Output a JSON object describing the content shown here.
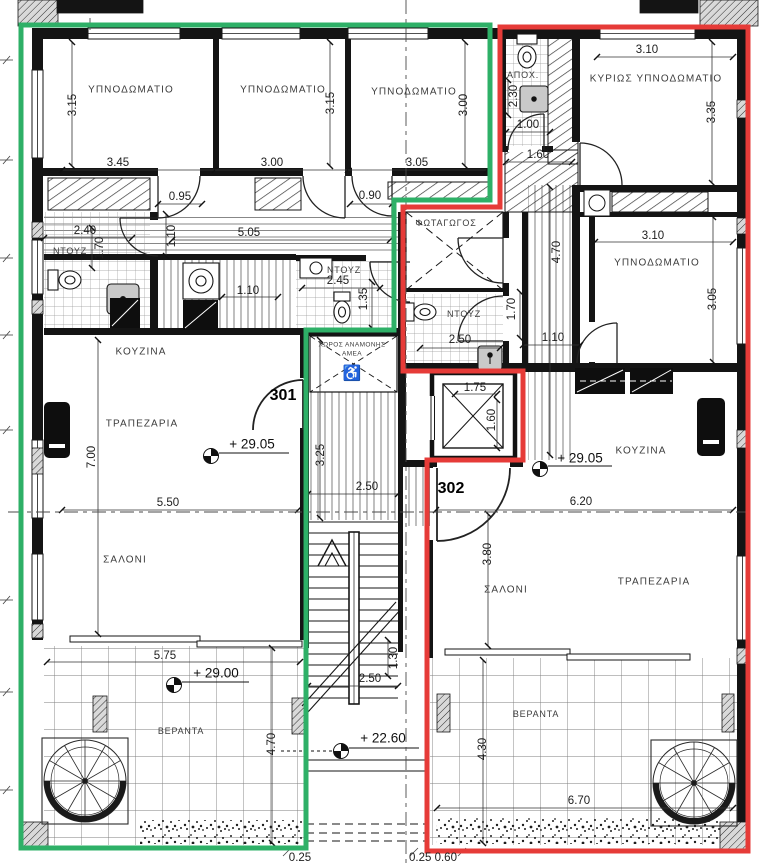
{
  "plan": {
    "type": "architectural-floor-plan",
    "floor_levels": [
      "+ 29.05",
      "+ 29.00",
      "+ 22.60"
    ],
    "apartments": [
      {
        "number": "301",
        "outline_color": "#2eb067",
        "rooms": [
          "ΥΠΝΟΔΩΜΑΤΙΟ",
          "ΥΠΝΟΔΩΜΑΤΙΟ",
          "ΥΠΝΟΔΩΜΑΤΙΟ",
          "ΝΤΟΥΖ",
          "ΝΤΟΥΖ",
          "ΚΟΥΖΙΝΑ",
          "ΤΡΑΠΕΖΑΡΙΑ",
          "ΣΑΛΟΝΙ",
          "ΒΕΡΑΝΤΑ"
        ]
      },
      {
        "number": "302",
        "outline_color": "#e63b38",
        "rooms": [
          "ΚΥΡΙΩΣ ΥΠΝΟΔΩΜΑΤΙΟ",
          "ΥΠΝΟΔΩΜΑΤΙΟ",
          "ΑΠΟΧ.",
          "ΝΤΟΥΖ",
          "ΚΟΥΖΙΝΑ",
          "ΣΑΛΟΝΙ",
          "ΤΡΑΠΕΖΑΡΙΑ",
          "ΒΕΡΑΝΤΑ"
        ]
      }
    ],
    "common_areas": [
      "ΦΩΤΑΓΩΓΟΣ",
      "ΧΩΡΟΣ ΑΝΑΜΟΝΗΣ ΑΜΕΑ"
    ]
  },
  "colors": {
    "outline_301": "#2eb067",
    "outline_302": "#e63b38",
    "linework": "#161616",
    "background": "#ffffff"
  },
  "labels": [
    {
      "n": "room-label-bedroom-1",
      "k": "room",
      "t": "ΥΠΝΟΔΩΜΑΤΙΟ",
      "x": 131,
      "y": 90
    },
    {
      "n": "room-label-bedroom-2",
      "k": "room",
      "t": "ΥΠΝΟΔΩΜΑΤΙΟ",
      "x": 283,
      "y": 90
    },
    {
      "n": "room-label-bedroom-3",
      "k": "room",
      "t": "ΥΠΝΟΔΩΜΑΤΙΟ",
      "x": 414,
      "y": 92
    },
    {
      "n": "room-label-master-bedroom",
      "k": "room",
      "t": "ΚΥΡΙΩΣ ΥΠΝΟΔΩΜΑΤΙΟ",
      "x": 656,
      "y": 79
    },
    {
      "n": "room-label-bedroom-302",
      "k": "room",
      "t": "ΥΠΝΟΔΩΜΑΤΙΟ",
      "x": 657,
      "y": 263
    },
    {
      "n": "room-label-kitchen-301",
      "k": "room",
      "t": "ΚΟΥΖΙΝΑ",
      "x": 141,
      "y": 352
    },
    {
      "n": "room-label-dining-301",
      "k": "room",
      "t": "ΤΡΑΠΕΖΑΡΙΑ",
      "x": 142,
      "y": 424
    },
    {
      "n": "room-label-living-301",
      "k": "room",
      "t": "ΣΑΛΟΝΙ",
      "x": 125,
      "y": 560
    },
    {
      "n": "room-label-kitchen-302",
      "k": "room",
      "t": "ΚΟΥΖΙΝΑ",
      "x": 641,
      "y": 451
    },
    {
      "n": "room-label-living-302",
      "k": "room",
      "t": "ΣΑΛΟΝΙ",
      "x": 506,
      "y": 590
    },
    {
      "n": "room-label-dining-302",
      "k": "room",
      "t": "ΤΡΑΠΕΖΑΡΙΑ",
      "x": 654,
      "y": 582
    },
    {
      "n": "room-label-veranda-301",
      "k": "small",
      "t": "ΒΕΡΑΝΤΑ",
      "x": 181,
      "y": 731
    },
    {
      "n": "room-label-veranda-302",
      "k": "small",
      "t": "ΒΕΡΑΝΤΑ",
      "x": 536,
      "y": 714
    },
    {
      "n": "room-label-shower-301",
      "k": "small",
      "t": "ΝΤΟΥΖ",
      "x": 70,
      "y": 251
    },
    {
      "n": "room-label-shower-301b",
      "k": "small",
      "t": "ΝΤΟΥΖ",
      "x": 344,
      "y": 270
    },
    {
      "n": "room-label-shower-302",
      "k": "small",
      "t": "ΝΤΟΥΖ",
      "x": 464,
      "y": 314
    },
    {
      "n": "room-label-wc",
      "k": "small",
      "t": "ΑΠΟΧ.",
      "x": 523,
      "y": 75
    },
    {
      "n": "room-label-lightwell",
      "k": "small",
      "t": "ΦΩΤΑΓΩΓΟΣ",
      "x": 446,
      "y": 223
    },
    {
      "n": "amea-waiting-label-1",
      "k": "tiny",
      "t": "ΧΩΡΟΣ ΑΝΑΜΟΝΗΣ",
      "x": 352,
      "y": 345
    },
    {
      "n": "amea-waiting-label-2",
      "k": "tiny",
      "t": "ΑΜΕΑ",
      "x": 352,
      "y": 354
    },
    {
      "n": "unit-number-301",
      "k": "unit",
      "t": "301",
      "x": 283,
      "y": 396
    },
    {
      "n": "unit-number-302",
      "k": "unit",
      "t": "302",
      "x": 451,
      "y": 489
    },
    {
      "n": "level-mark-301",
      "k": "level",
      "t": "+  29.05",
      "x": 252,
      "y": 444
    },
    {
      "n": "level-mark-302",
      "k": "level",
      "t": "+  29.05",
      "x": 580,
      "y": 458
    },
    {
      "n": "level-mark-veranda",
      "k": "level",
      "t": "+  29.00",
      "x": 216,
      "y": 673
    },
    {
      "n": "level-mark-stairs",
      "k": "level",
      "t": "+  22.60",
      "x": 383,
      "y": 738
    },
    {
      "n": "dim-3-45",
      "k": "dim",
      "t": "3.45",
      "x": 118,
      "y": 163
    },
    {
      "n": "dim-3-00a",
      "k": "dim",
      "t": "3.00",
      "x": 272,
      "y": 163
    },
    {
      "n": "dim-3-05a",
      "k": "dim",
      "t": "3.05",
      "x": 417,
      "y": 163
    },
    {
      "n": "dim-0-95",
      "k": "dim",
      "t": "0.95",
      "x": 180,
      "y": 197
    },
    {
      "n": "dim-0-90",
      "k": "dim",
      "t": "0.90",
      "x": 370,
      "y": 196
    },
    {
      "n": "dim-2-40",
      "k": "dim",
      "t": "2.40",
      "x": 85,
      "y": 231
    },
    {
      "n": "dim-5-05",
      "k": "dim",
      "t": "5.05",
      "x": 249,
      "y": 233
    },
    {
      "n": "dim-1-10a",
      "k": "dim",
      "t": "1.10",
      "x": 172,
      "y": 236,
      "r": 1
    },
    {
      "n": "dim-1-70a",
      "k": "dim",
      "t": "1.70",
      "x": 100,
      "y": 248,
      "r": 1
    },
    {
      "n": "dim-2-45",
      "k": "dim",
      "t": "2.45",
      "x": 338,
      "y": 281
    },
    {
      "n": "dim-1-35",
      "k": "dim",
      "t": "1.35",
      "x": 364,
      "y": 299,
      "r": 1
    },
    {
      "n": "dim-1-10b",
      "k": "dim",
      "t": "1.10",
      "x": 248,
      "y": 291
    },
    {
      "n": "dim-3-15a",
      "k": "dim",
      "t": "3.15",
      "x": 73,
      "y": 105,
      "r": 1
    },
    {
      "n": "dim-3-15b",
      "k": "dim",
      "t": "3.15",
      "x": 331,
      "y": 103,
      "r": 1
    },
    {
      "n": "dim-3-00b",
      "k": "dim",
      "t": "3.00",
      "x": 464,
      "y": 105,
      "r": 1
    },
    {
      "n": "dim-3-10a",
      "k": "dim",
      "t": "3.10",
      "x": 647,
      "y": 50
    },
    {
      "n": "dim-2-30",
      "k": "dim",
      "t": "2.30",
      "x": 514,
      "y": 96,
      "r": 1
    },
    {
      "n": "dim-1-00",
      "k": "dim",
      "t": "1.00",
      "x": 528,
      "y": 125
    },
    {
      "n": "dim-1-60a",
      "k": "dim",
      "t": "1.60",
      "x": 538,
      "y": 155
    },
    {
      "n": "dim-3-35",
      "k": "dim",
      "t": "3.35",
      "x": 712,
      "y": 112,
      "r": 1
    },
    {
      "n": "dim-3-10b",
      "k": "dim",
      "t": "3.10",
      "x": 653,
      "y": 236
    },
    {
      "n": "dim-3-05b",
      "k": "dim",
      "t": "3.05",
      "x": 713,
      "y": 299,
      "r": 1
    },
    {
      "n": "dim-4-70a",
      "k": "dim",
      "t": "4.70",
      "x": 557,
      "y": 252,
      "r": 1
    },
    {
      "n": "dim-1-70b",
      "k": "dim",
      "t": "1.70",
      "x": 512,
      "y": 309,
      "r": 1
    },
    {
      "n": "dim-2-50a",
      "k": "dim",
      "t": "2.50",
      "x": 460,
      "y": 340
    },
    {
      "n": "dim-1-10c",
      "k": "dim",
      "t": "1.10",
      "x": 553,
      "y": 338
    },
    {
      "n": "dim-1-75",
      "k": "dim",
      "t": "1.75",
      "x": 475,
      "y": 388
    },
    {
      "n": "dim-1-60b",
      "k": "dim",
      "t": "1.60",
      "x": 492,
      "y": 420,
      "r": 1
    },
    {
      "n": "dim-7-00",
      "k": "dim",
      "t": "7.00",
      "x": 92,
      "y": 457,
      "r": 1
    },
    {
      "n": "dim-5-50",
      "k": "dim",
      "t": "5.50",
      "x": 168,
      "y": 503
    },
    {
      "n": "dim-6-20",
      "k": "dim",
      "t": "6.20",
      "x": 581,
      "y": 502
    },
    {
      "n": "dim-3-80",
      "k": "dim",
      "t": "3.80",
      "x": 488,
      "y": 554,
      "r": 1
    },
    {
      "n": "dim-3-25",
      "k": "dim",
      "t": "3.25",
      "x": 321,
      "y": 455,
      "r": 1
    },
    {
      "n": "dim-2-50b",
      "k": "dim",
      "t": "2.50",
      "x": 367,
      "y": 487
    },
    {
      "n": "dim-5-75",
      "k": "dim",
      "t": "5.75",
      "x": 165,
      "y": 656
    },
    {
      "n": "dim-4-70b",
      "k": "dim",
      "t": "4.70",
      "x": 272,
      "y": 744,
      "r": 1
    },
    {
      "n": "dim-4-30",
      "k": "dim",
      "t": "4.30",
      "x": 483,
      "y": 749,
      "r": 1
    },
    {
      "n": "dim-6-70",
      "k": "dim",
      "t": "6.70",
      "x": 579,
      "y": 801
    },
    {
      "n": "dim-1-30",
      "k": "dim",
      "t": "1.30",
      "x": 394,
      "y": 658,
      "r": 1
    },
    {
      "n": "dim-2-50c",
      "k": "dim",
      "t": "2.50",
      "x": 370,
      "y": 679
    },
    {
      "n": "dim-0-25a",
      "k": "dim",
      "t": "0.25",
      "x": 300,
      "y": 858
    },
    {
      "n": "dim-0-25-0-60",
      "k": "dim",
      "t": "0.25  0.60",
      "x": 433,
      "y": 858
    },
    {
      "n": "wheelchair-icon",
      "k": "icon",
      "t": "♿",
      "x": 352,
      "y": 373
    }
  ]
}
